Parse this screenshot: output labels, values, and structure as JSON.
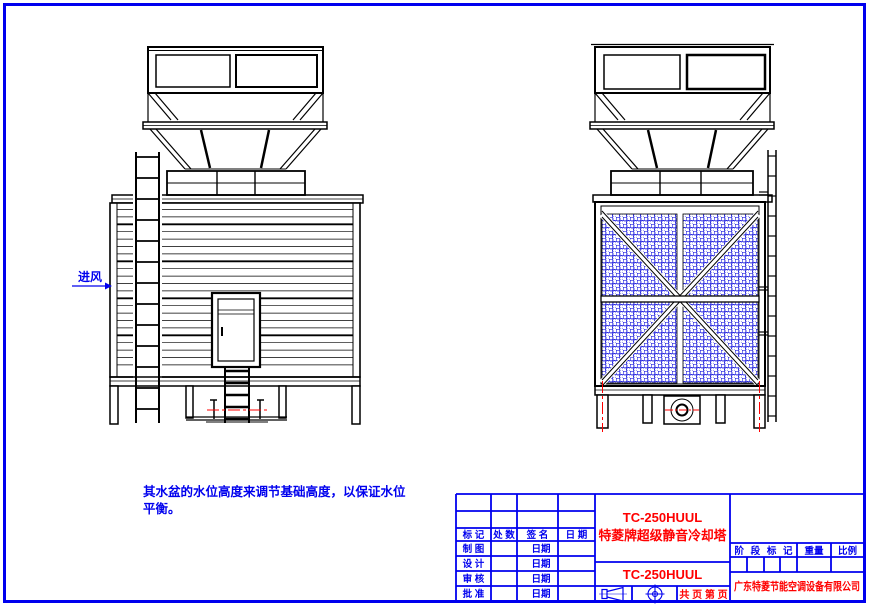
{
  "page": {
    "background": "#ffffff",
    "border_color": "#0000ee",
    "line_color": "#000000",
    "accent_red": "#ff0000",
    "mesh_color": "#2020dd"
  },
  "drawing": {
    "air_inlet_label": "进风",
    "note_line1": "其水盆的水位高度来调节基础高度，以保证水位",
    "note_line2": "平衡。"
  },
  "title_block": {
    "revision_headers": [
      "标 记",
      "处 数",
      "签 名",
      "日 期"
    ],
    "rows": [
      {
        "label": "制 图",
        "date": "日期"
      },
      {
        "label": "设 计",
        "date": "日期"
      },
      {
        "label": "审 核",
        "date": "日期"
      },
      {
        "label": "批 准",
        "date": "日期"
      }
    ],
    "product_model": "TC-250HUUL",
    "product_name": "特菱牌超级静音冷却塔",
    "model_cell": "TC-250HUUL",
    "pages_label": "共  页 第  页",
    "stage_label": "阶段标记",
    "weight_label": "重量",
    "scale_label": "比例",
    "company": "广东特菱节能空调设备有限公司"
  }
}
